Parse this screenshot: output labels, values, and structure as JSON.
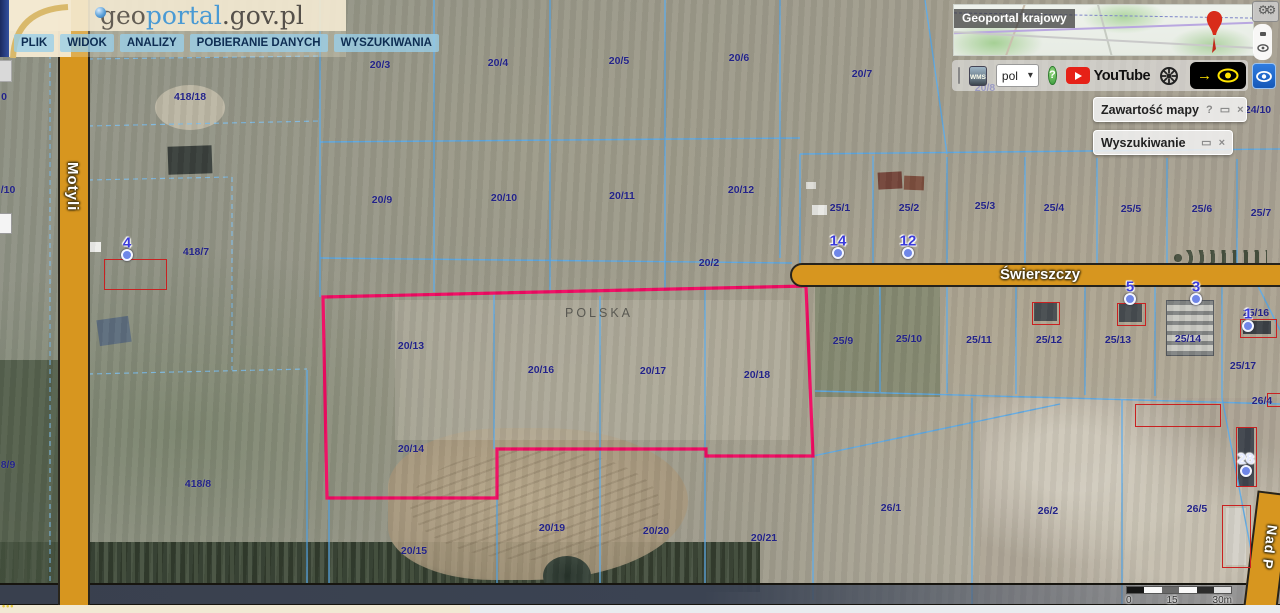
{
  "header": {
    "logo": {
      "part1": "geo",
      "part2": "portal",
      "part3": ".gov.pl"
    },
    "menu": [
      "PLIK",
      "WIDOK",
      "ANALIZY",
      "POBIERANIE DANYCH",
      "WYSZUKIWANIA"
    ]
  },
  "overview_map": {
    "title": "Geoportal krajowy"
  },
  "toolbar": {
    "language": "pol",
    "youtube_label": "YouTube",
    "help_label": "?",
    "arrow_glyph": "→",
    "wms_label": "WMS"
  },
  "panels": {
    "map_content": {
      "title": "Zawartość mapy",
      "help": "?",
      "maximize": "▭",
      "close": "×"
    },
    "search": {
      "title": "Wyszukiwanie",
      "maximize": "▭",
      "close": "×"
    }
  },
  "map": {
    "country_label": "POLSKA",
    "streets": {
      "vertical": "Motyli",
      "horizontal": "Świerszczy",
      "corner": "Nad P"
    },
    "scalebar": {
      "start": "0",
      "middle": "15",
      "end": "30m"
    },
    "colors": {
      "selection": "#f00a62",
      "parcel_line": "#58a9e9",
      "road_fill": "#d7961f",
      "label_blue": "#232388",
      "building_red": "#c92121"
    },
    "parcels": [
      {
        "label": "0",
        "x": 4,
        "y": 97
      },
      {
        "label": "/10",
        "x": 8,
        "y": 190
      },
      {
        "label": "8/9",
        "x": 8,
        "y": 465
      },
      {
        "label": "418/18",
        "x": 190,
        "y": 97
      },
      {
        "label": "418/7",
        "x": 196,
        "y": 252
      },
      {
        "label": "418/8",
        "x": 198,
        "y": 484
      },
      {
        "label": "20/3",
        "x": 380,
        "y": 65
      },
      {
        "label": "20/4",
        "x": 498,
        "y": 63
      },
      {
        "label": "20/5",
        "x": 619,
        "y": 61
      },
      {
        "label": "20/6",
        "x": 739,
        "y": 58
      },
      {
        "label": "20/7",
        "x": 862,
        "y": 74
      },
      {
        "label": "20/8",
        "x": 985,
        "y": 88
      },
      {
        "label": "20/9",
        "x": 382,
        "y": 200
      },
      {
        "label": "20/10",
        "x": 504,
        "y": 198
      },
      {
        "label": "20/11",
        "x": 622,
        "y": 196
      },
      {
        "label": "20/12",
        "x": 741,
        "y": 190
      },
      {
        "label": "20/2",
        "x": 709,
        "y": 263
      },
      {
        "label": "24/10",
        "x": 1258,
        "y": 110
      },
      {
        "label": "25/1",
        "x": 840,
        "y": 208
      },
      {
        "label": "25/2",
        "x": 909,
        "y": 208
      },
      {
        "label": "25/3",
        "x": 985,
        "y": 206
      },
      {
        "label": "25/4",
        "x": 1054,
        "y": 208
      },
      {
        "label": "25/5",
        "x": 1131,
        "y": 209
      },
      {
        "label": "25/6",
        "x": 1202,
        "y": 209
      },
      {
        "label": "25/7",
        "x": 1261,
        "y": 213
      },
      {
        "label": "25/9",
        "x": 843,
        "y": 341
      },
      {
        "label": "25/10",
        "x": 909,
        "y": 339
      },
      {
        "label": "25/11",
        "x": 979,
        "y": 340
      },
      {
        "label": "25/12",
        "x": 1049,
        "y": 340
      },
      {
        "label": "25/13",
        "x": 1118,
        "y": 340
      },
      {
        "label": "25/14",
        "x": 1188,
        "y": 339
      },
      {
        "label": "25/16",
        "x": 1256,
        "y": 313
      },
      {
        "label": "25/17",
        "x": 1243,
        "y": 366
      },
      {
        "label": "26/4",
        "x": 1262,
        "y": 401
      },
      {
        "label": "20/13",
        "x": 411,
        "y": 346
      },
      {
        "label": "20/16",
        "x": 541,
        "y": 370
      },
      {
        "label": "20/17",
        "x": 653,
        "y": 371
      },
      {
        "label": "20/18",
        "x": 757,
        "y": 375
      },
      {
        "label": "20/14",
        "x": 411,
        "y": 449
      },
      {
        "label": "20/15",
        "x": 414,
        "y": 551
      },
      {
        "label": "20/19",
        "x": 552,
        "y": 528
      },
      {
        "label": "20/20",
        "x": 656,
        "y": 531
      },
      {
        "label": "20/21",
        "x": 764,
        "y": 538
      },
      {
        "label": "26/1",
        "x": 891,
        "y": 508
      },
      {
        "label": "26/2",
        "x": 1048,
        "y": 511
      },
      {
        "label": "26/5",
        "x": 1197,
        "y": 509
      }
    ],
    "addresses": [
      {
        "num": "4",
        "x": 127,
        "y": 243
      },
      {
        "num": "14",
        "x": 838,
        "y": 241
      },
      {
        "num": "12",
        "x": 908,
        "y": 241
      },
      {
        "num": "5",
        "x": 1130,
        "y": 287
      },
      {
        "num": "3",
        "x": 1196,
        "y": 287
      },
      {
        "num": "1",
        "x": 1248,
        "y": 314
      },
      {
        "num": "28",
        "x": 1246,
        "y": 459,
        "color": "#e4e9ff"
      }
    ],
    "buildings": [
      [
        104,
        259,
        61,
        29
      ],
      [
        1032,
        302,
        26,
        21
      ],
      [
        1117,
        303,
        27,
        21
      ],
      [
        1240,
        319,
        35,
        17
      ],
      [
        1135,
        404,
        84,
        21
      ],
      [
        1236,
        427,
        19,
        58
      ],
      [
        1222,
        505,
        27,
        61
      ],
      [
        1267,
        393,
        13,
        12
      ]
    ]
  }
}
